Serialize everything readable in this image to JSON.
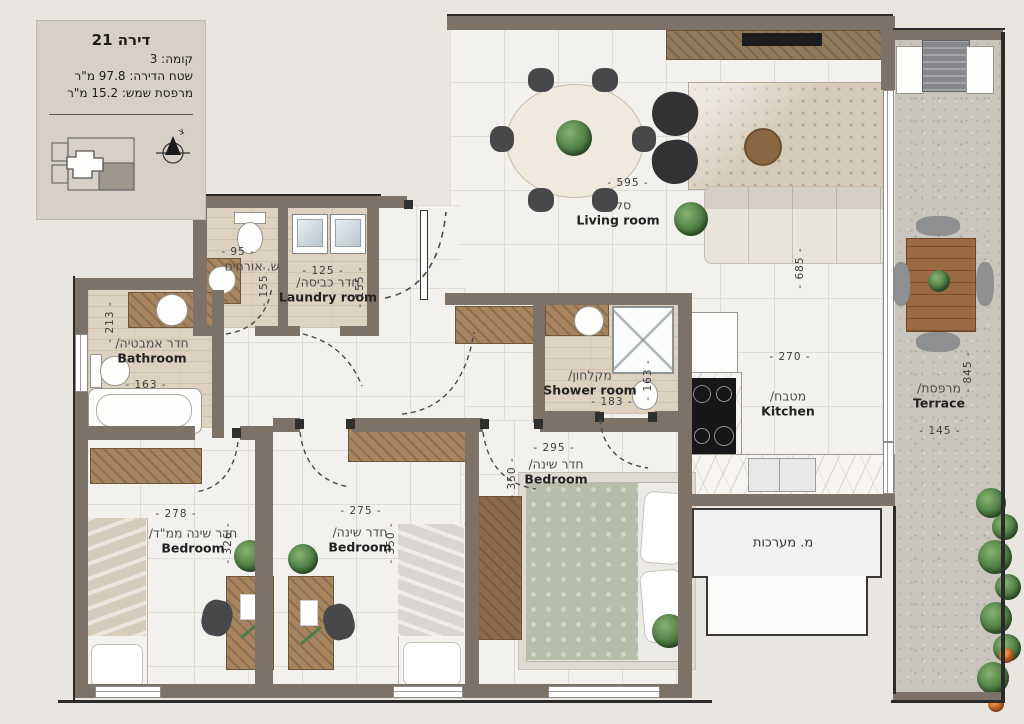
{
  "info_box": {
    "title": "דירה 21",
    "floor_line": "קומה: 3",
    "area_line": "שטח הדירה: 97.8 מ\"ר",
    "terrace_line": "מרפסת שמש: 15.2 מ\"ר",
    "north_label": "צ"
  },
  "rooms": {
    "living": {
      "he": "סלון/",
      "en": "Living room"
    },
    "kitchen": {
      "he": "מטבח/",
      "en": "Kitchen"
    },
    "guest_wc": {
      "he": "ש. אורחים",
      "en": ""
    },
    "laundry": {
      "he": "חדר כביסה/",
      "en": "Laundry room"
    },
    "bathroom": {
      "he": "חדר אמבטיה/",
      "en": "Bathroom"
    },
    "shower": {
      "he": "מקלחון/",
      "en": "Shower room"
    },
    "bedroom_mamad": {
      "he": "חדר שינה ממ\"ד/",
      "en": "Bedroom"
    },
    "bedroom_middle": {
      "he": "חדר שינה/",
      "en": "Bedroom"
    },
    "bedroom_master": {
      "he": "חדר שינה/",
      "en": "Bedroom"
    },
    "terrace": {
      "he": "מרפסת/",
      "en": "Terrace"
    },
    "systems": {
      "he": "מ. מערכות",
      "en": ""
    }
  },
  "dimensions_cm": {
    "living_width": "- 595 -",
    "living_height": "- 685 -",
    "kitchen_width": "- 270 -",
    "guest_wc_width": "- 95 -",
    "guest_wc_height": "- 155 -",
    "laundry_width": "- 125 -",
    "laundry_height": "- 155 -",
    "bathroom_height": "- 213 -",
    "bathroom_width": "- 163 -",
    "shower_height": "- 163 -",
    "shower_width": "- 183 -",
    "master_width": "- 295 -",
    "master_height": "- 350 -",
    "mamad_width": "- 278 -",
    "mamad_height": "- 326 -",
    "middle_width": "- 275 -",
    "middle_height": "- 350 -",
    "terrace_height": "- 845 -",
    "terrace_width": "- 145 -"
  },
  "colors": {
    "background": "#e9e6e2",
    "info_box": "#d6d0c8",
    "wall": "#7c7267",
    "tile_floor": "#f2f1ee",
    "wood_floor": "#ddd2c0",
    "terrace_floor": "#c9c5bd",
    "wood_furniture": "#a5845f",
    "plant_green": "#4c7a41",
    "text": "#3d3d3d"
  }
}
